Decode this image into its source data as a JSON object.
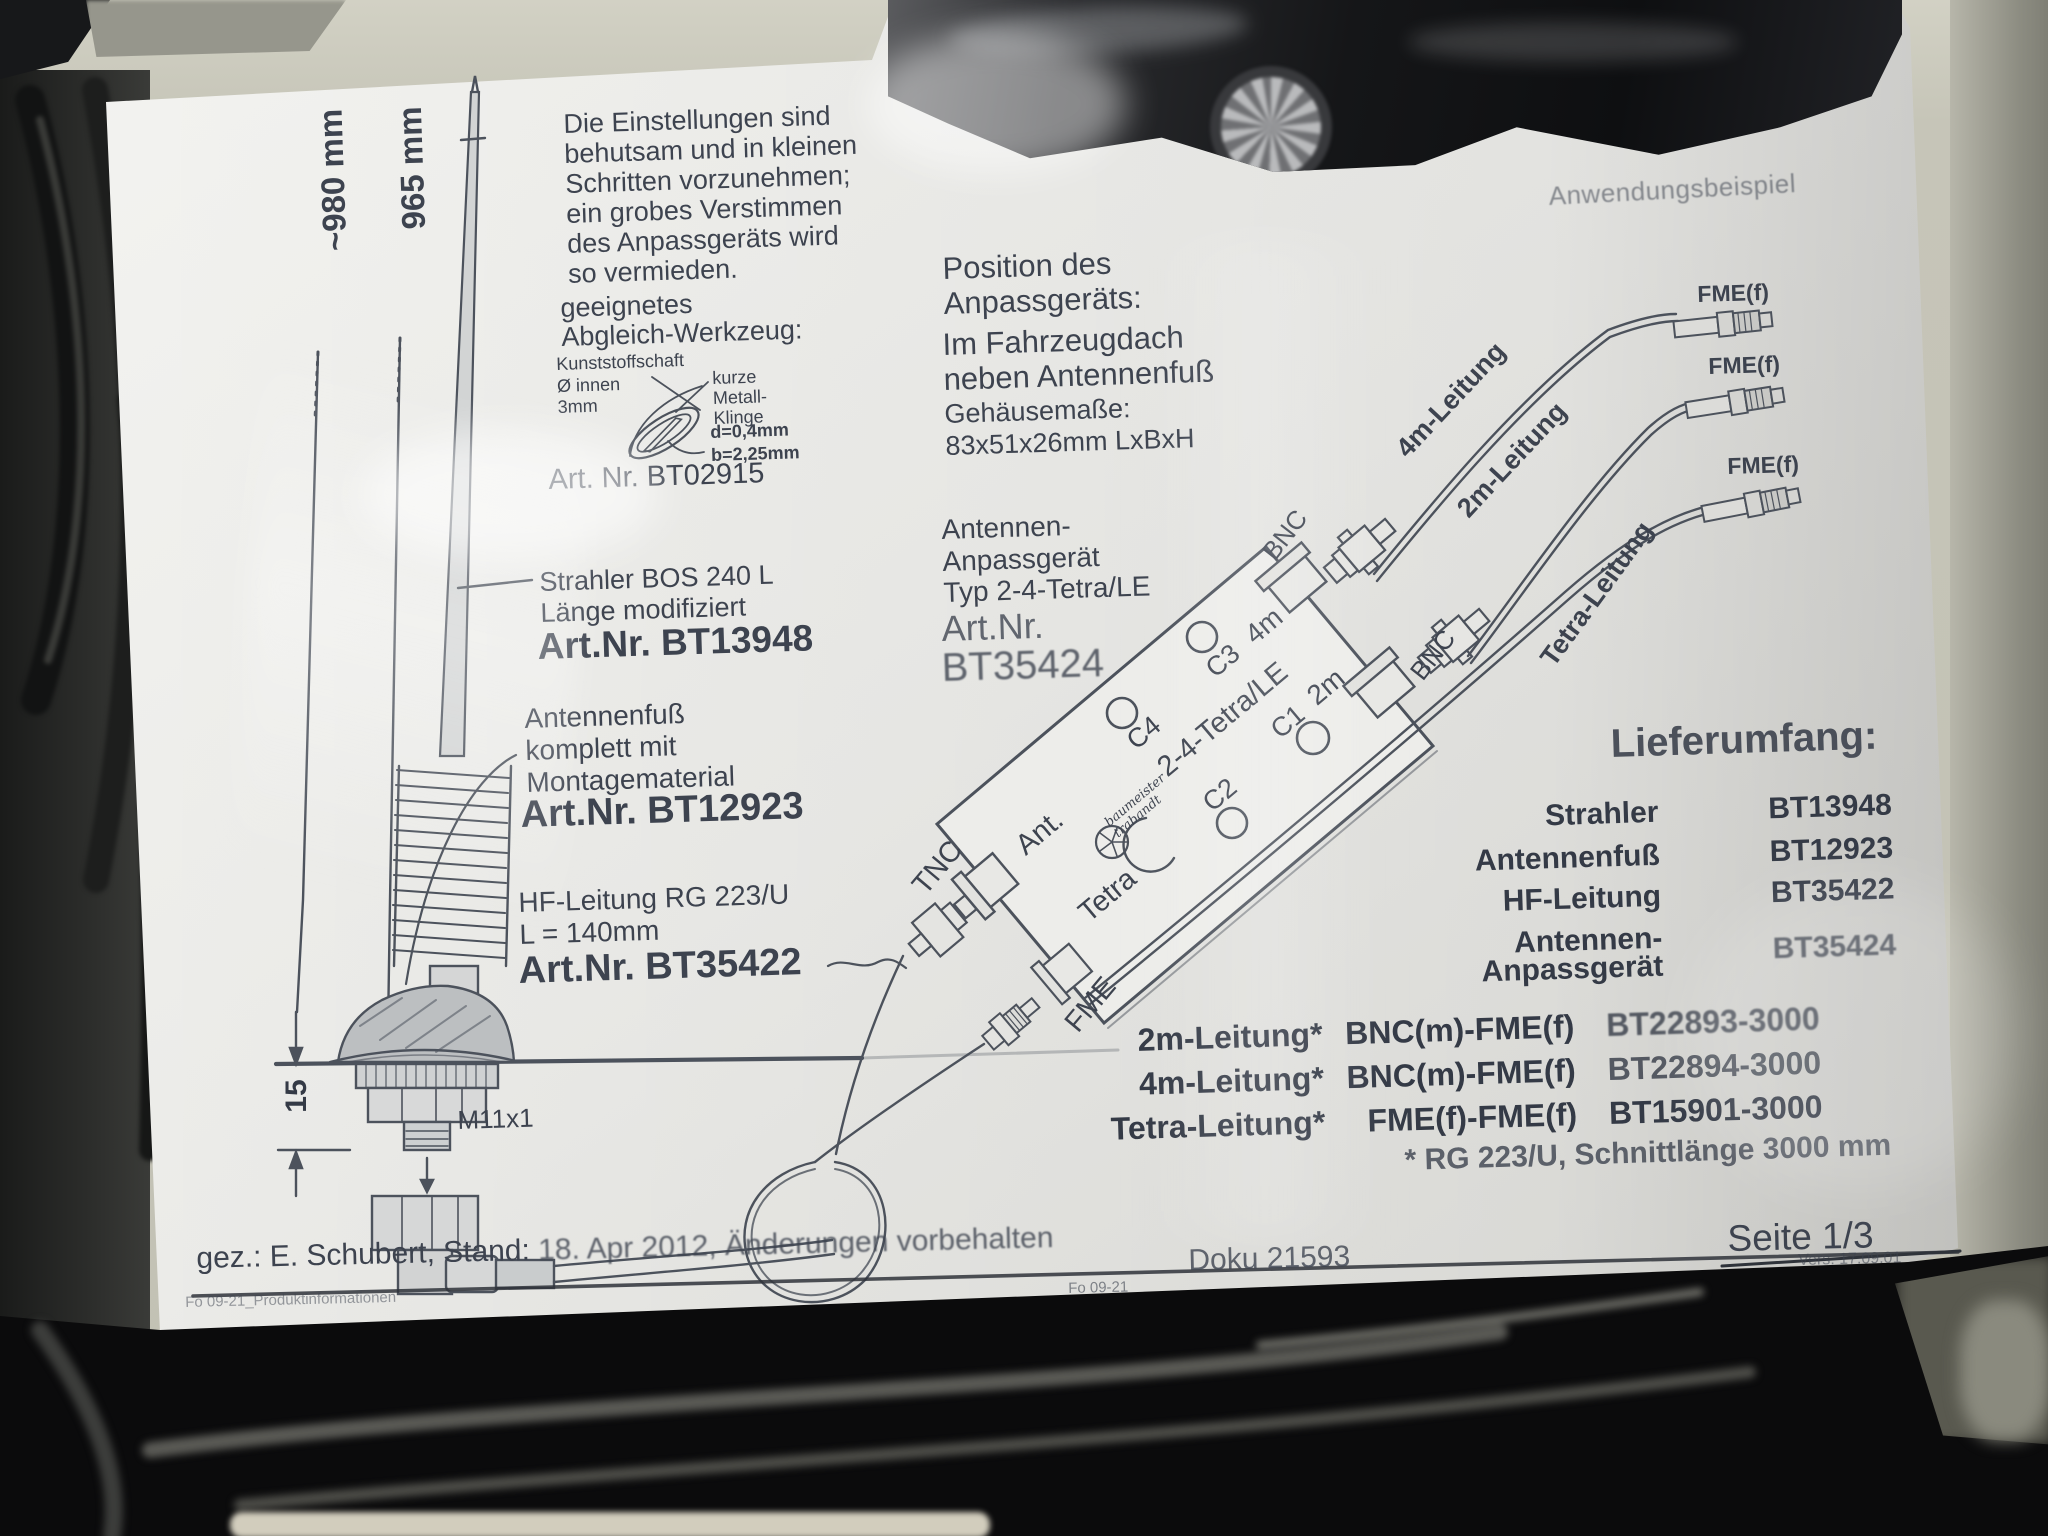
{
  "measurements": {
    "total_len": "~980 mm",
    "whip_len": "965 mm",
    "base_h": "15",
    "thread": "M11x1"
  },
  "adjust_note": {
    "text": "Die Einstellungen sind\nbehutsam und in kleinen\nSchritten vorzunehmen;\nein grobes Verstimmen\ndes Anpassgeräts wird\nso vermieden."
  },
  "tool": {
    "heading": "geeignetes\nAbgleich-Werkzeug:",
    "shaft": "Kunststoffschaft\nØ innen\n3mm",
    "blade": "kurze\nMetall-\nKlinge",
    "blade_dims": "d=0,4mm\nb=2,25mm",
    "art": "Art. Nr. BT02915"
  },
  "strahler": {
    "desc": "Strahler BOS 240 L\nLänge modifiziert",
    "art": "Art.Nr. BT13948"
  },
  "fuss": {
    "desc": "Antennenfuß\nkomplett mit\nMontagematerial",
    "art": "Art.Nr. BT12923"
  },
  "hf": {
    "desc": "HF-Leitung RG 223/U\nL = 140mm",
    "art": "Art.Nr. BT35422"
  },
  "position": {
    "heading": "Position des\nAnpassgeräts:",
    "body": "Im Fahrzeugdach\nneben Antennenfuß",
    "case": "Gehäusemaße:\n83x51x26mm  LxBxH"
  },
  "anpass": {
    "desc": "Antennen-\nAnpassgerät\nTyp 2-4-Tetra/LE",
    "art_label": "Art.Nr.",
    "art_no": "BT35424"
  },
  "device": {
    "p4m": "4m",
    "p2m": "2m",
    "c1": "C1",
    "c2": "C2",
    "c3": "C3",
    "c4": "C4",
    "model": "2-4-Tetra/LE",
    "ant": "Ant.",
    "tetra": "Tetra",
    "tnc": "TNC",
    "fme": "FME",
    "bnc_a": "BNC",
    "bnc_b": "BNC",
    "logo": "baumeister\ntrabandt"
  },
  "application": {
    "title": "Anwendungsbeispiel",
    "fme_f1": "FME(f)",
    "fme_f2": "FME(f)",
    "fme_f3": "FME(f)",
    "lead_4m": "4m-Leitung",
    "lead_2m": "2m-Leitung",
    "lead_tetra": "Tetra-Leitung"
  },
  "lieferumfang": {
    "title": "Lieferumfang:",
    "rows": [
      {
        "label": "Strahler",
        "value": "BT13948"
      },
      {
        "label": "Antennenfuß",
        "value": "BT12923"
      },
      {
        "label": "HF-Leitung",
        "value": "BT35422"
      },
      {
        "label": "Antennen-\nAnpassgerät",
        "value": "BT35424"
      }
    ]
  },
  "cable_table": {
    "rows": [
      {
        "name": "2m-Leitung*",
        "conn": "BNC(m)-FME(f)",
        "art": "BT22893-3000"
      },
      {
        "name": "4m-Leitung*",
        "conn": "BNC(m)-FME(f)",
        "art": "BT22894-3000"
      },
      {
        "name": "Tetra-Leitung*",
        "conn": "FME(f)-FME(f)",
        "art": "BT15901-3000"
      }
    ],
    "footnote": "* RG 223/U, Schnittlänge 3000 mm"
  },
  "footer": {
    "gez_label": "gez.: E. Schubert,  Stand: ",
    "gez_rest": "18. Apr 2012,  Änderungen vorbehalten",
    "doku": "Doku 21593",
    "seite": "Seite 1/3",
    "vers": "Vers.  17.09.01",
    "form_left": "Fo 09-21_Produktinformationen",
    "form_mid": "Fo 09-21"
  },
  "colors": {
    "ink": "#3d434f",
    "paper": "#efefec",
    "bag": "#c6c5b8"
  }
}
